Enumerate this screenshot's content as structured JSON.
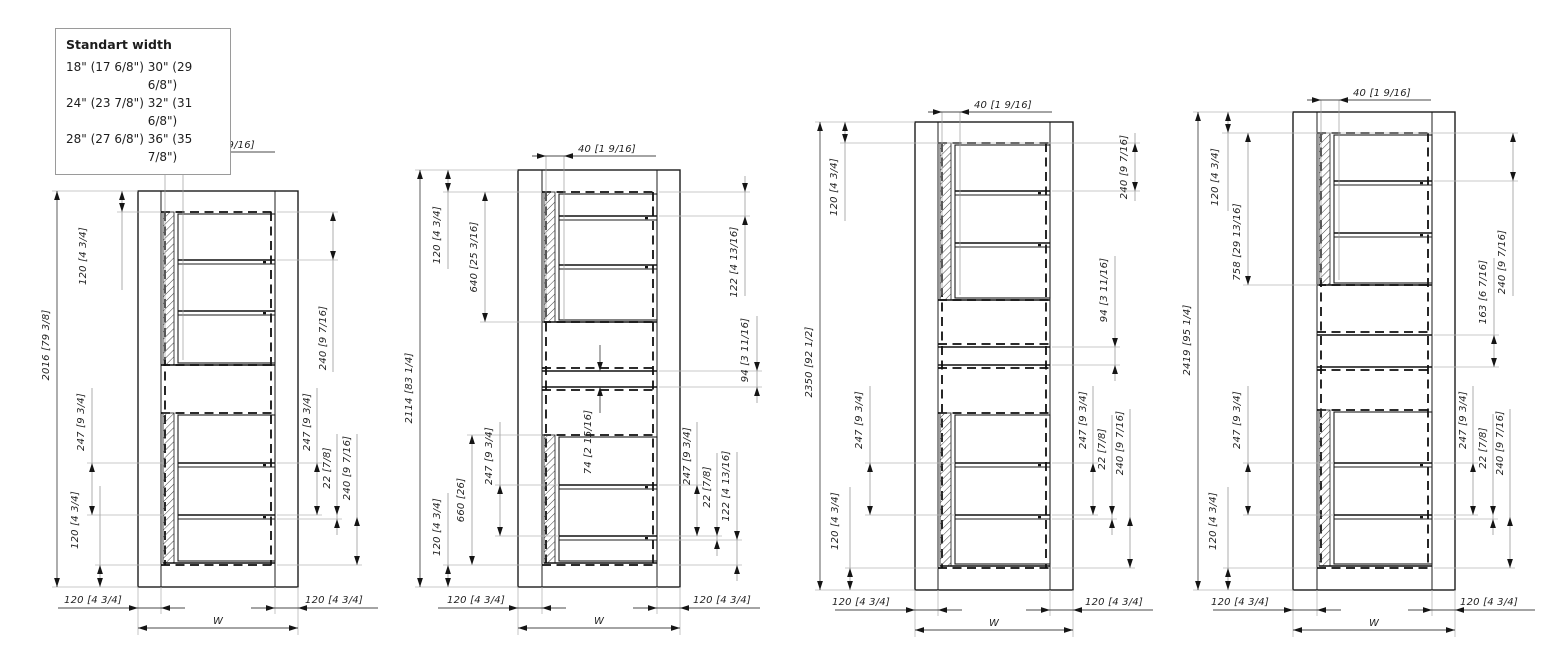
{
  "legend": {
    "title": "Standart width",
    "rows": [
      {
        "col1": "18\" (17 6/8\")",
        "col2": "30\" (29 6/8\")"
      },
      {
        "col1": "24\" (23 7/8\")",
        "col2": "32\" (31 6/8\")"
      },
      {
        "col1": "28\" (27 6/8\")",
        "col2": "36\" (35 7/8\")"
      }
    ]
  },
  "colors": {
    "line": "#1c1c1c",
    "extension_line": "#b8b8b8",
    "background": "#ffffff"
  },
  "panels": [
    {
      "name": "elevation-2016",
      "labels": {
        "top_offset": "40 [1 9/16]",
        "overall_height": "2016 [79 3/8]",
        "left_top": "120 [4 3/4]",
        "left_shelf_gap": "247 [9 3/4]",
        "left_bottom": "120 [4 3/4]",
        "right_top": "240 [9 7/16]",
        "right_shelf_gap": "247 [9 3/4]",
        "right_shelf_thickness": "22 [7/8]",
        "right_bottom_gap": "240 [9 7/16]",
        "bottom_left": "120 [4 3/4]",
        "bottom_right": "120 [4 3/4]",
        "width": "W"
      }
    },
    {
      "name": "elevation-2114",
      "labels": {
        "top_offset": "40 [1 9/16]",
        "overall_height": "2114 [83 1/4]",
        "left_top": "120 [4 3/4]",
        "left_upper_module": "640 [25 3/16]",
        "left_lower_module": "660 [26]",
        "left_shelf_gap": "247 [9 3/4]",
        "left_bottom": "120 [4 3/4]",
        "middle_band": "74 [2 15/16]",
        "right_top": "122 [4 13/16]",
        "right_band": "94 [3 11/16]",
        "right_shelf_gap": "247 [9 3/4]",
        "right_shelf_thickness": "22 [7/8]",
        "right_bottom_gap": "122 [4 13/16]",
        "bottom_left": "120 [4 3/4]",
        "bottom_right": "120 [4 3/4]",
        "width": "W"
      }
    },
    {
      "name": "elevation-2350",
      "labels": {
        "top_offset": "40 [1 9/16]",
        "overall_height": "2350 [92 1/2]",
        "left_top": "120 [4 3/4]",
        "left_shelf_gap": "247 [9 3/4]",
        "left_bottom": "120 [4 3/4]",
        "right_top": "240 [9 7/16]",
        "right_band": "94 [3 11/16]",
        "right_shelf_gap": "247 [9 3/4]",
        "right_shelf_thickness": "22 [7/8]",
        "right_bottom_gap": "240 [9 7/16]",
        "bottom_left": "120 [4 3/4]",
        "bottom_right": "120 [4 3/4]",
        "width": "W"
      }
    },
    {
      "name": "elevation-2419",
      "labels": {
        "top_offset": "40 [1 9/16]",
        "overall_height": "2419 [95 1/4]",
        "left_top": "120 [4 3/4]",
        "left_upper_module": "758 [29 13/16]",
        "left_shelf_gap": "247 [9 3/4]",
        "left_bottom": "120 [4 3/4]",
        "right_top": "240 [9 7/16]",
        "right_band": "163 [6 7/16]",
        "right_shelf_gap": "247 [9 3/4]",
        "right_shelf_thickness": "22 [7/8]",
        "right_bottom_gap": "240 [9 7/16]",
        "bottom_left": "120 [4 3/4]",
        "bottom_right": "120 [4 3/4]",
        "width": "W"
      }
    }
  ]
}
